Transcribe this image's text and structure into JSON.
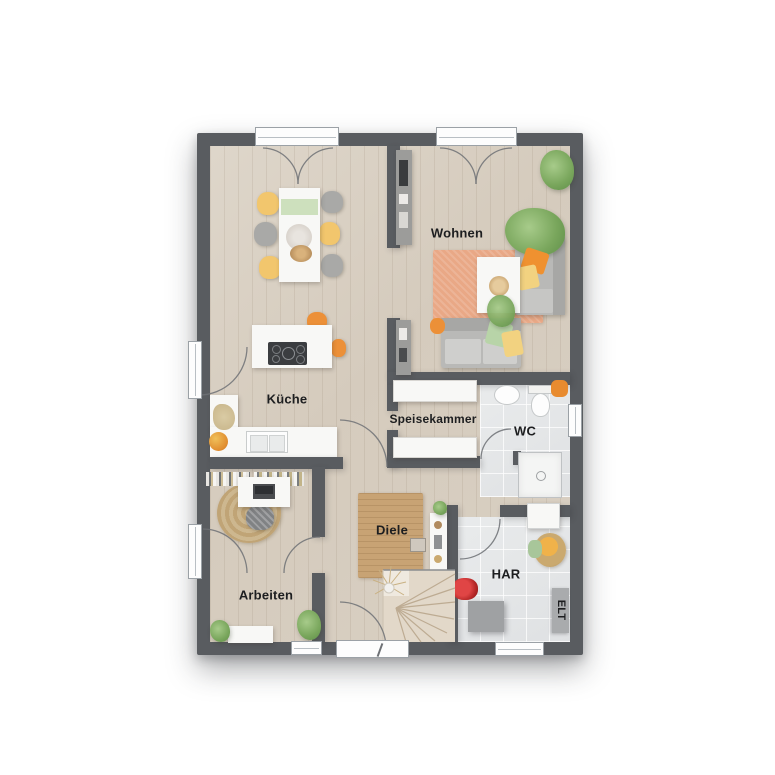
{
  "plan_title": "floor-plan-ground-floor",
  "rooms": {
    "wohnen": {
      "label": "Wohnen"
    },
    "kueche": {
      "label": "Küche"
    },
    "speisekammer": {
      "label": "Speisekammer"
    },
    "wc": {
      "label": "WC"
    },
    "diele": {
      "label": "Diele"
    },
    "arbeiten": {
      "label": "Arbeiten"
    },
    "har": {
      "label": "HAR"
    },
    "elt": {
      "label": "ELT"
    }
  },
  "colors": {
    "wall": "#595c60",
    "wood_floor": "#d7cdc0",
    "tile_floor": "#e4e6e7",
    "living_rug": "#e9a886",
    "hall_rug": "#c8a374",
    "sofa_gray": "#b9b9b7",
    "chair_yellow": "#f2c66d",
    "accent_orange": "#ec9038",
    "plant_green": "#79a65c",
    "furniture_white": "#f8f8f6"
  }
}
